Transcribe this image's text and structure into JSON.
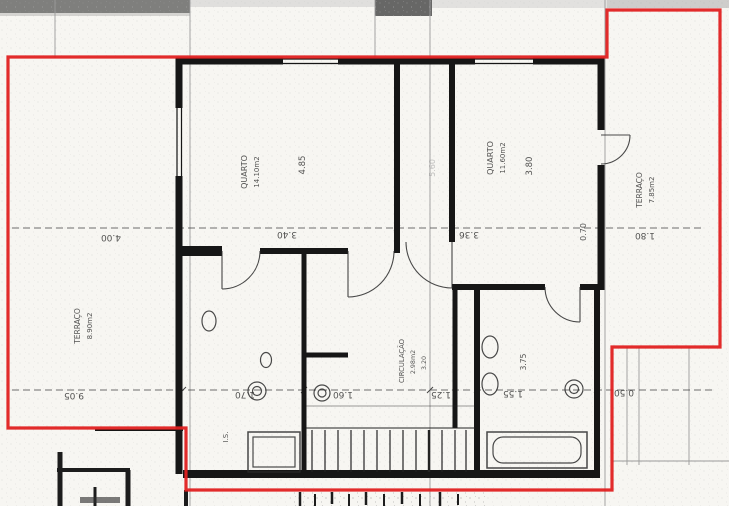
{
  "plan": {
    "outline_color": "#e02020",
    "paper_color": "#f7f6f2",
    "line_color": "#1a1a1a",
    "rooms": {
      "quarto_left": {
        "name": "QUARTO",
        "area": "14.10m2",
        "dim": "4.85"
      },
      "quarto_right": {
        "name": "QUARTO",
        "area": "11.60m2",
        "dim": "3.80"
      },
      "circulacao": {
        "name": "CIRCULAÇÃO",
        "area": "2.98m2",
        "dim": "3.20"
      },
      "terraco_left": {
        "name": "TERRAÇO",
        "area": "8.90m2"
      },
      "terraco_right": {
        "name": "TERRAÇO",
        "area": "7.85m2"
      },
      "is_left": {
        "name": "I.S."
      }
    },
    "dims": {
      "upper": {
        "d1": "4.00",
        "d2": "3.40",
        "d3": "3.36",
        "d4": "1.80",
        "v1": "0.70",
        "v2": "5.60"
      },
      "lower": {
        "d1": "9.05",
        "d2": "1.70",
        "d3": "1.60",
        "d4": "1.25",
        "d5": "1.55",
        "d6": "0.50",
        "v1": "3.75"
      }
    }
  }
}
